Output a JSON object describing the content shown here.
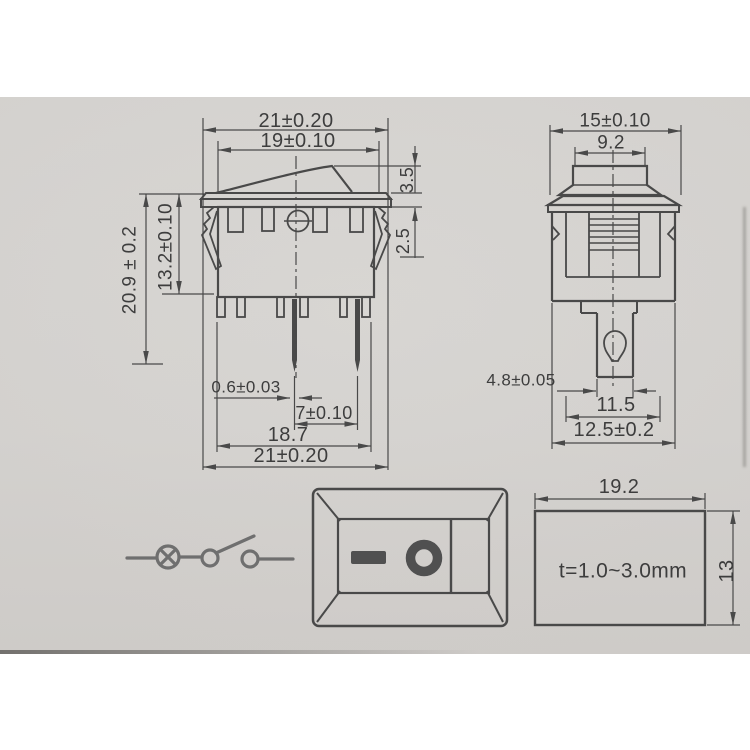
{
  "colors": {
    "paper": "#d7d5d2",
    "line": "#474747",
    "text": "#3b3b3b",
    "symbol_fill": "#4f4f4f",
    "schematic_line": "#6e6e6e"
  },
  "front_view": {
    "dim_overall_width_top": "21±0.20",
    "dim_rocker_width": "19±0.10",
    "dim_rocker_height": "3.5",
    "dim_flange_to_clip": "2.5",
    "dim_overall_height": "20.9 ± 0.2",
    "dim_body_depth": "13.2±0.10",
    "dim_pin_thickness": "0.6±0.03",
    "dim_pin_pitch": "7±0.10",
    "dim_terminal_span": "18.7",
    "dim_overall_width_bottom": "21±0.20"
  },
  "side_view": {
    "dim_flange_width": "15±0.10",
    "dim_actuator_width": "9.2",
    "dim_terminal_tab_width": "4.8±0.05",
    "dim_body_width": "11.5",
    "dim_overall_width": "12.5±0.2"
  },
  "panel_cutout": {
    "dim_cutout_width": "19.2",
    "dim_cutout_height": "13",
    "panel_thickness_note": "t=1.0~3.0mm"
  }
}
